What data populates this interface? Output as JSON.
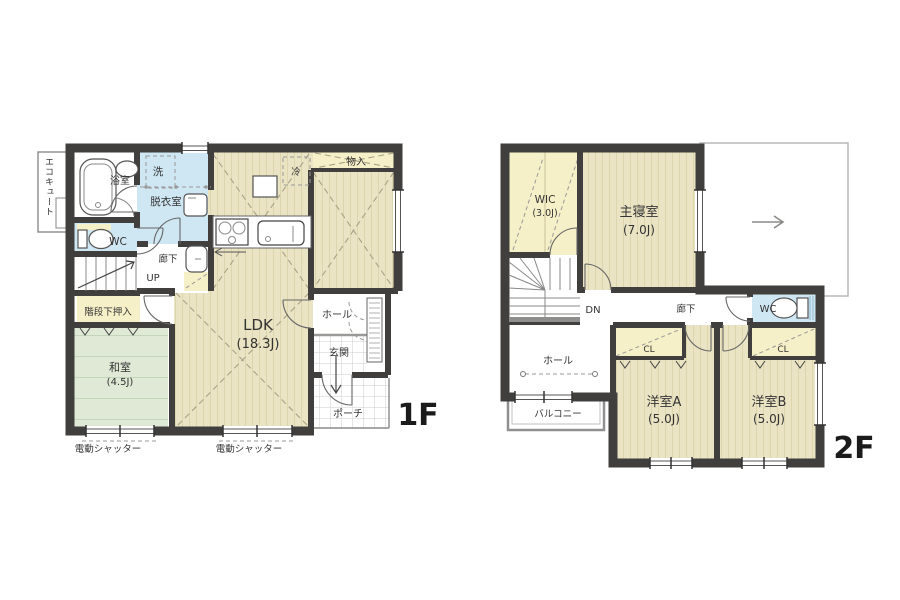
{
  "palette": {
    "wall": "#403f3d",
    "wood_floor": "#eae4c4",
    "wood_line": "#ddd6ad",
    "tatami": "#dfe9d6",
    "tatami_line": "#c4d5ba",
    "water_blue": "#cfe7f3",
    "closet_cream": "#f6f0c8",
    "tile_line": "#cccccc",
    "dash_line": "#a9a288",
    "ink": "#333333"
  },
  "floor1": {
    "label": "1F",
    "eco": "エコキュート",
    "bath": "浴室",
    "laundry": "洗",
    "dressing": "脱衣室",
    "wc": "WC",
    "corridor": "廊下",
    "up": "UP",
    "under_stair": "階段下押入",
    "tatami": "和室",
    "tatami_size": "(4.5J)",
    "ldk": "LDK",
    "ldk_size": "(18.3J)",
    "fridge": "冷",
    "storage": "物入",
    "hall": "ホール",
    "entrance": "玄関",
    "porch": "ポーチ",
    "shutter_a": "電動シャッター",
    "shutter_b": "電動シャッター"
  },
  "floor2": {
    "label": "2F",
    "wic": "WIC",
    "wic_size": "(3.0J)",
    "master": "主寝室",
    "master_size": "(7.0J)",
    "dn": "DN",
    "corridor": "廊下",
    "wc": "WC",
    "hall": "ホール",
    "balcony": "バルコニー",
    "cl_a": "CL",
    "cl_b": "CL",
    "room_a": "洋室A",
    "room_a_size": "(5.0J)",
    "room_b": "洋室B",
    "room_b_size": "(5.0J)"
  }
}
